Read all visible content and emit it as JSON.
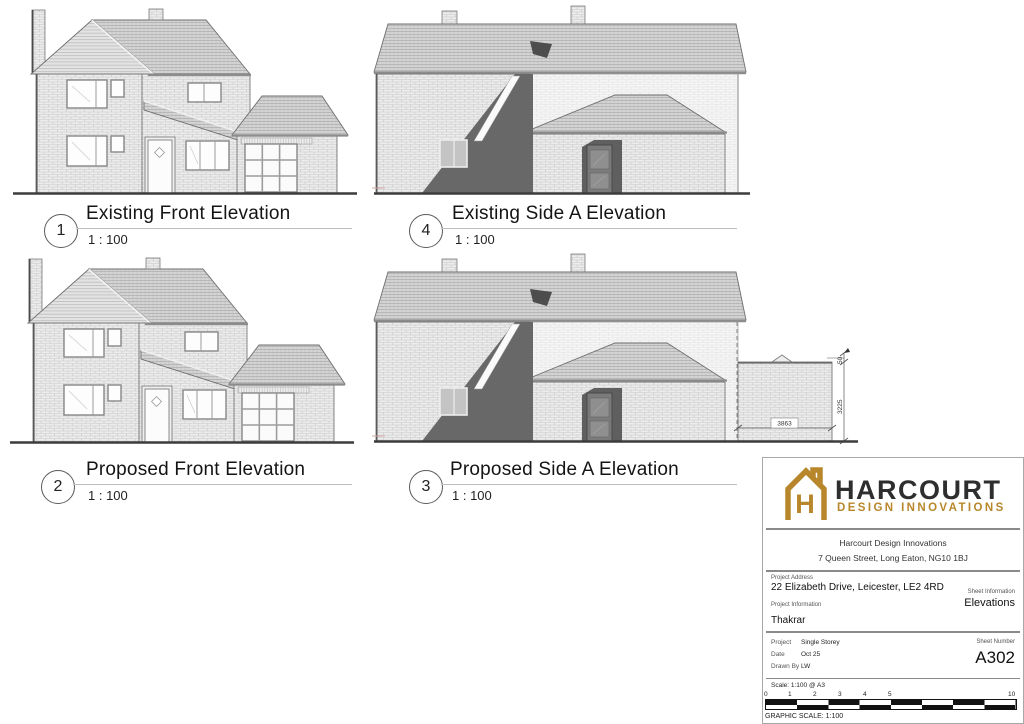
{
  "views": [
    {
      "number": "1",
      "title": "Existing Front Elevation",
      "scale": "1 : 100"
    },
    {
      "number": "4",
      "title": "Existing Side A Elevation",
      "scale": "1 : 100"
    },
    {
      "number": "2",
      "title": "Proposed Front Elevation",
      "scale": "1 : 100"
    },
    {
      "number": "3",
      "title": "Proposed Side A Elevation",
      "scale": "1 : 100"
    }
  ],
  "annotations": {
    "ext_width": "3863",
    "ext_height": "3225",
    "ext_top_offset": "50"
  },
  "title_block": {
    "logo": {
      "name": "HARCOURT",
      "tagline": "DESIGN INNOVATIONS",
      "gold": "#B8872B",
      "dark": "#2E2E2E"
    },
    "company_name": "Harcourt Design Innovations",
    "company_address": "7 Queen Street, Long Eaton, NG10 1BJ",
    "project_address_label": "Project Address",
    "project_address": "22 Elizabeth Drive, Leicester, LE2 4RD",
    "sheet_information_label": "Sheet Information",
    "sheet_information": "Elevations",
    "project_information_label": "Project Information",
    "project_information": "Thakrar",
    "project_label": "Project",
    "project_value": "Single Storey",
    "date_label": "Date",
    "date_value": "Oct 25",
    "drawn_by_label": "Drawn By",
    "drawn_by_value": "LW",
    "sheet_number_label": "Sheet Number",
    "sheet_number": "A302",
    "scale_note": "Scale: 1:100 @ A3",
    "graphic_scale_label": "GRAPHIC SCALE: 1:100",
    "scale_bar": {
      "ticks": [
        "0",
        "1",
        "2",
        "3",
        "4",
        "5",
        "10"
      ]
    }
  }
}
